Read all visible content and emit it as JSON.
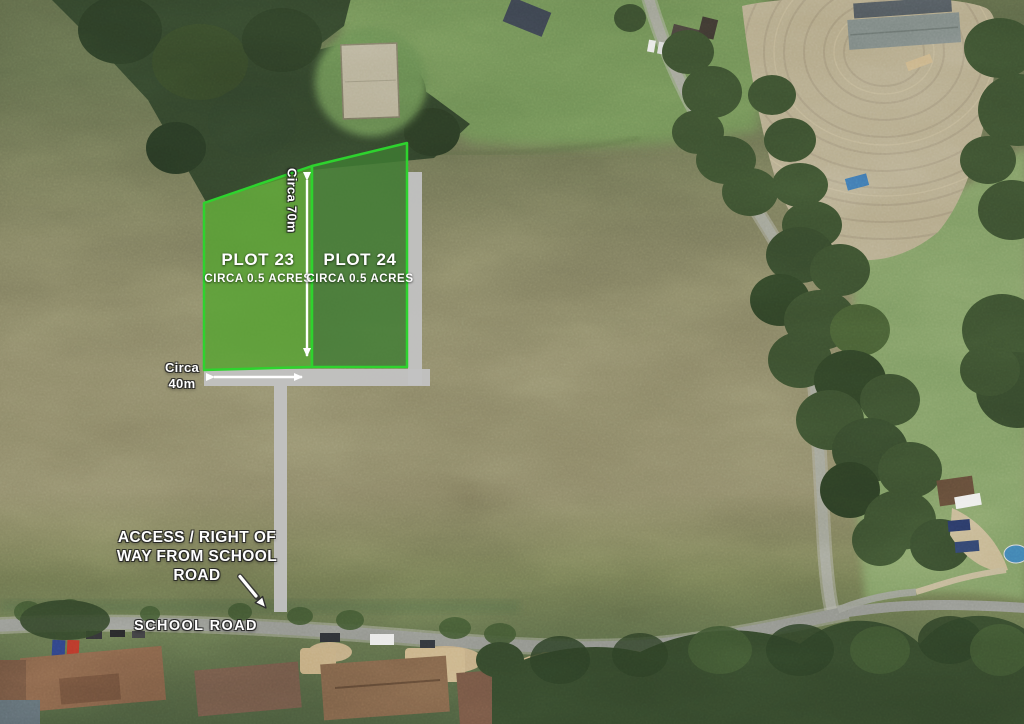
{
  "map": {
    "type": "aerial-site-plan",
    "plots": [
      {
        "title": "PLOT 23",
        "subtitle": "CIRCA 0.5 ACRES"
      },
      {
        "title": "PLOT 24",
        "subtitle": "CIRCA 0.5 ACRES"
      }
    ],
    "dimensions": {
      "height_label": "Circa 70m",
      "width_label": "Circa\n40m"
    },
    "annotations": {
      "access_note": "ACCESS / RIGHT OF\nWAY FROM SCHOOL\nROAD",
      "road_name": "SCHOOL ROAD"
    },
    "colors": {
      "plot_border": "#2ed32e",
      "plot23_fill": "#54a52f",
      "plot24_fill": "#407c33",
      "access_way": "#c2c2c2",
      "arrow": "#ffffff",
      "label_text": "#ffffff"
    }
  }
}
